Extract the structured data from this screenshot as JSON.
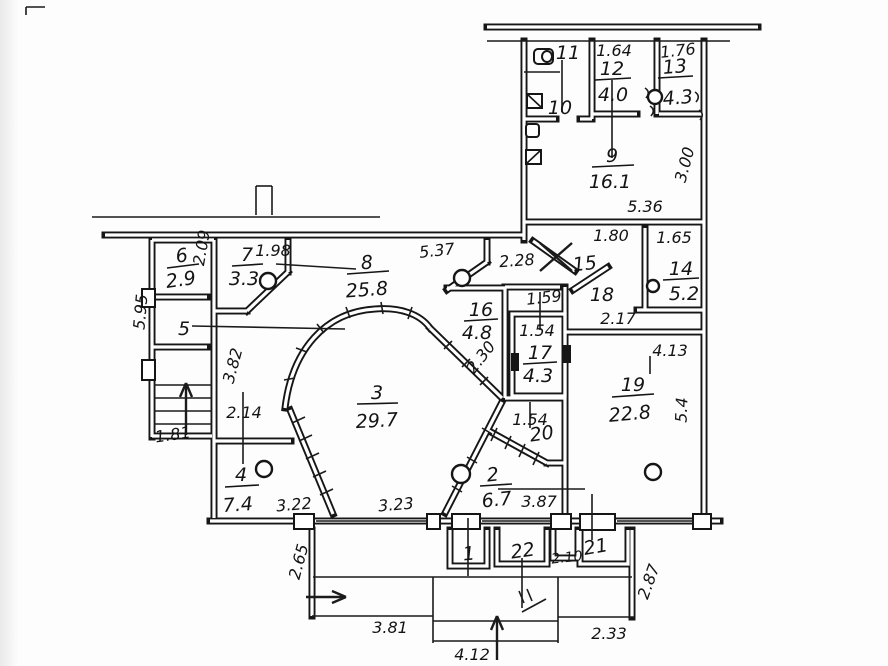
{
  "plan": {
    "rooms": [
      {
        "number": "1",
        "area": ""
      },
      {
        "number": "2",
        "area": "6.7"
      },
      {
        "number": "3",
        "area": "29.7"
      },
      {
        "number": "4",
        "area": "7.4"
      },
      {
        "number": "5",
        "area": ""
      },
      {
        "number": "6",
        "area": "2.9"
      },
      {
        "number": "7",
        "area": "3.3"
      },
      {
        "number": "8",
        "area": "25.8"
      },
      {
        "number": "9",
        "area": "16.1"
      },
      {
        "number": "10",
        "area": ""
      },
      {
        "number": "11",
        "area": ""
      },
      {
        "number": "12",
        "area": "4.0"
      },
      {
        "number": "13",
        "area": "4.3"
      },
      {
        "number": "14",
        "area": "5.2"
      },
      {
        "number": "15",
        "area": ""
      },
      {
        "number": "16",
        "area": "4.8"
      },
      {
        "number": "17",
        "area": "4.3"
      },
      {
        "number": "18",
        "area": ""
      },
      {
        "number": "19",
        "area": "22.8"
      },
      {
        "number": "20",
        "area": ""
      },
      {
        "number": "21",
        "area": ""
      },
      {
        "number": "22",
        "area": ""
      }
    ],
    "dims": {
      "k164": "1.64",
      "k176": "1.76",
      "k536": "5.36",
      "k300": "3.00",
      "k180": "1.80",
      "k165": "1.65",
      "k537": "5.37",
      "k228": "2.28",
      "k198": "1.98",
      "k209": "2.09",
      "k595": "5.95",
      "k382": "3.82",
      "k214": "2.14",
      "k181": "1.81",
      "k322": "3.22",
      "k323": "3.23",
      "k159": "1.59",
      "k154a": "1.54",
      "k230": "2.30",
      "k217": "2.17",
      "k413": "4.13",
      "k54": "5.4",
      "k154b": "1.54",
      "k387": "3.87",
      "k210": "2.10",
      "k265": "2.65",
      "k381": "3.81",
      "k412": "4.12",
      "k233": "2.33",
      "k287": "2.87"
    },
    "icons": [
      "toilet-icon",
      "sink-icon",
      "stove-icon",
      "kitchen-sink-icon",
      "stairs-up-arrow",
      "balcony-exit-arrow",
      "balcony-up-arrow",
      "vent-circle",
      "entry-cross-mark"
    ]
  }
}
